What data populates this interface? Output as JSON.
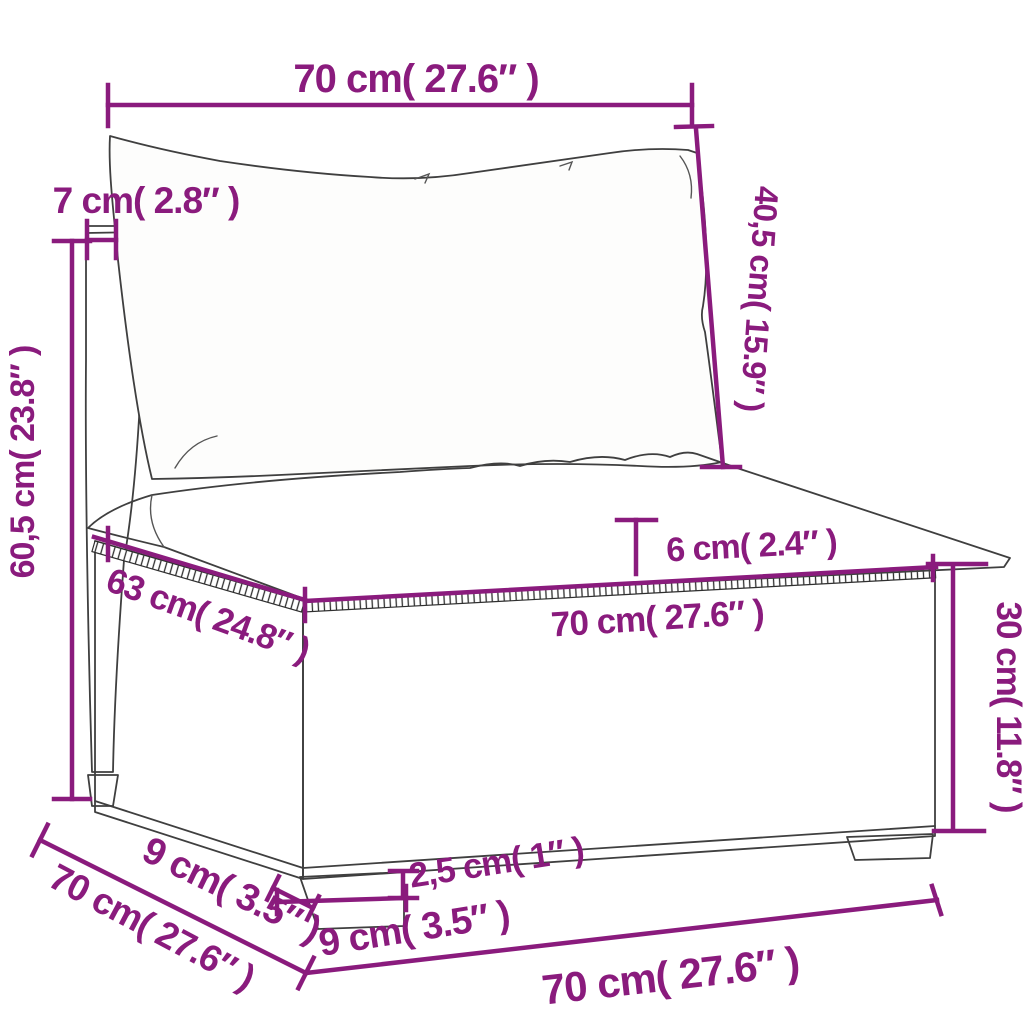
{
  "meta": {
    "type": "product-dimension-diagram",
    "subject": "poly rattan garden sofa middle section with back and seat cushions"
  },
  "colors": {
    "dimension_accent": "#8a1b7d",
    "drawing_outline": "#3f3f3f",
    "weave_stroke": "#2f2f2f",
    "background": "#ffffff",
    "pillow_fill": "#fdfdfc",
    "cushion_fill": "#f6f5f1"
  },
  "dims": [
    {
      "id": "back-width",
      "label": "70 cm( 27.6″ )"
    },
    {
      "id": "back-cushion-height",
      "label": "40,5 cm( 15.9″ )"
    },
    {
      "id": "backrest-thickness",
      "label": "7 cm( 2.8″ )"
    },
    {
      "id": "total-height",
      "label": "60,5 cm( 23.8″ )"
    },
    {
      "id": "seat-cushion-thickness",
      "label": "6 cm( 2.4″ )"
    },
    {
      "id": "seat-depth",
      "label": "63 cm( 24.8″ )"
    },
    {
      "id": "seat-width",
      "label": "70 cm( 27.6″ )"
    },
    {
      "id": "base-height",
      "label": "30 cm( 11.8″ )"
    },
    {
      "id": "leg-height",
      "label": "2,5 cm( 1″ )"
    },
    {
      "id": "leg-front-width",
      "label": "9 cm( 3.5″ )"
    },
    {
      "id": "leg-side-depth",
      "label": "9 cm( 3.5″ )"
    },
    {
      "id": "base-side-depth",
      "label": "70 cm( 27.6″ )"
    },
    {
      "id": "base-front-width",
      "label": "70 cm( 27.6″ )"
    }
  ]
}
